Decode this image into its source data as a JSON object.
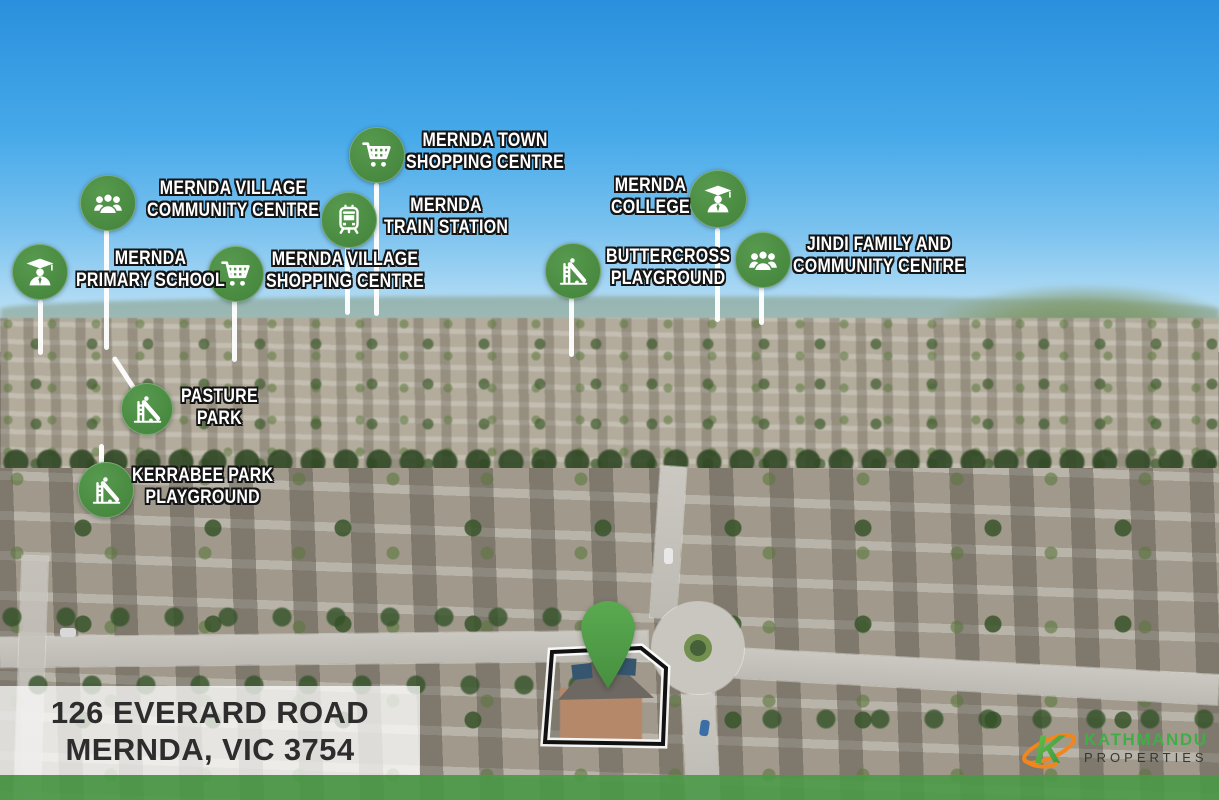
{
  "property": {
    "address_line1": "126 EVERARD ROAD",
    "address_line2": "MERNDA, VIC 3754"
  },
  "brand": {
    "name": "KATHMANDU",
    "subtitle": "PROPERTIES",
    "logo_mark": "K",
    "name_color": "#3fae47",
    "subtitle_color": "#343834",
    "swoosh_color": "#f0861c"
  },
  "colors": {
    "marker_green": "#4d9147",
    "pin_green": "#55a04b",
    "footer_band_green": "#4a9947",
    "label_text": "#ffffff",
    "label_outline": "#151515",
    "address_text": "#2d2d2d",
    "address_panel_bg": "rgba(255,255,255,0.74)"
  },
  "markers": [
    {
      "id": "mernda-town-shopping-centre",
      "icon": "shopping-cart",
      "line1": "MERNDA TOWN",
      "line2": "SHOPPING CENTRE"
    },
    {
      "id": "mernda-village-community-centre",
      "icon": "people-group",
      "line1": "MERNDA VILLAGE",
      "line2": "COMMUNITY CENTRE"
    },
    {
      "id": "mernda-train-station",
      "icon": "train",
      "line1": "MERNDA",
      "line2": "TRAIN STATION"
    },
    {
      "id": "mernda-college",
      "icon": "graduate",
      "line1": "MERNDA",
      "line2": "COLLEGE"
    },
    {
      "id": "jindi-family-and-community-centre",
      "icon": "people-group",
      "line1": "JINDI FAMILY AND",
      "line2": "COMMUNITY CENTRE"
    },
    {
      "id": "buttercross-playground",
      "icon": "playground-slide",
      "line1": "BUTTERCROSS",
      "line2": "PLAYGROUND"
    },
    {
      "id": "mernda-primary-school",
      "icon": "graduate",
      "line1": "MERNDA",
      "line2": "PRIMARY SCHOOL"
    },
    {
      "id": "mernda-village-shopping-centre",
      "icon": "shopping-cart",
      "line1": "MERNDA VILLAGE",
      "line2": "SHOPPING CENTRE"
    },
    {
      "id": "pasture-park",
      "icon": "playground-slide",
      "line1": "PASTURE",
      "line2": "PARK"
    },
    {
      "id": "kerrabee-park-playground",
      "icon": "playground-slide",
      "line1": "KERRABEE PARK",
      "line2": "PLAYGROUND"
    }
  ]
}
